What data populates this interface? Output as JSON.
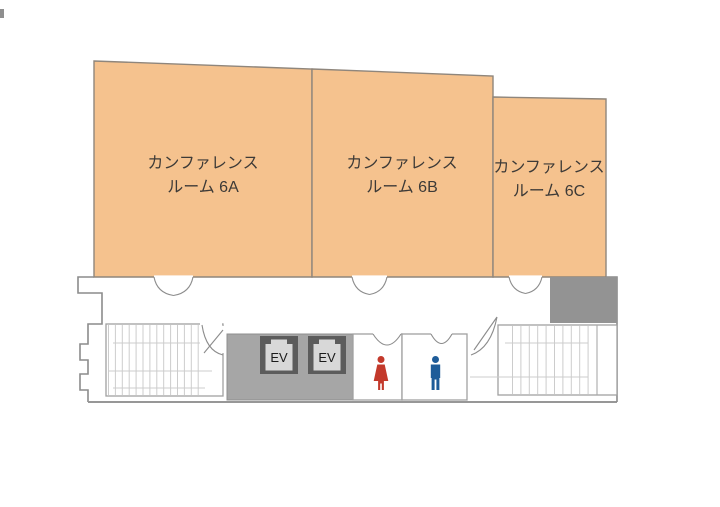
{
  "map_title": "conference-floor-map",
  "rooms": [
    {
      "id": "6A",
      "line1": "カンファレンス",
      "line2": "ルーム 6A"
    },
    {
      "id": "6B",
      "line1": "カンファレンス",
      "line2": "ルーム 6B"
    },
    {
      "id": "6C",
      "line1": "カンファレンス",
      "line2": "ルーム 6C"
    }
  ],
  "elevators": [
    {
      "label": "EV"
    },
    {
      "label": "EV"
    }
  ],
  "restrooms": {
    "female_icon": "female-figure",
    "male_icon": "male-figure"
  },
  "colors": {
    "room_fill": "#F5C28E",
    "room_border": "#8F867C",
    "wall": "#8C8C8C",
    "elevator_hall": "#A6A6A6",
    "service_block": "#939393",
    "ev_frame": "#5C5C5C",
    "ev_inner": "#D8D8D8",
    "stair_line": "#CCCCCC",
    "female": "#C3392B",
    "male": "#1E5C99",
    "label_text": "#3D3A37"
  }
}
